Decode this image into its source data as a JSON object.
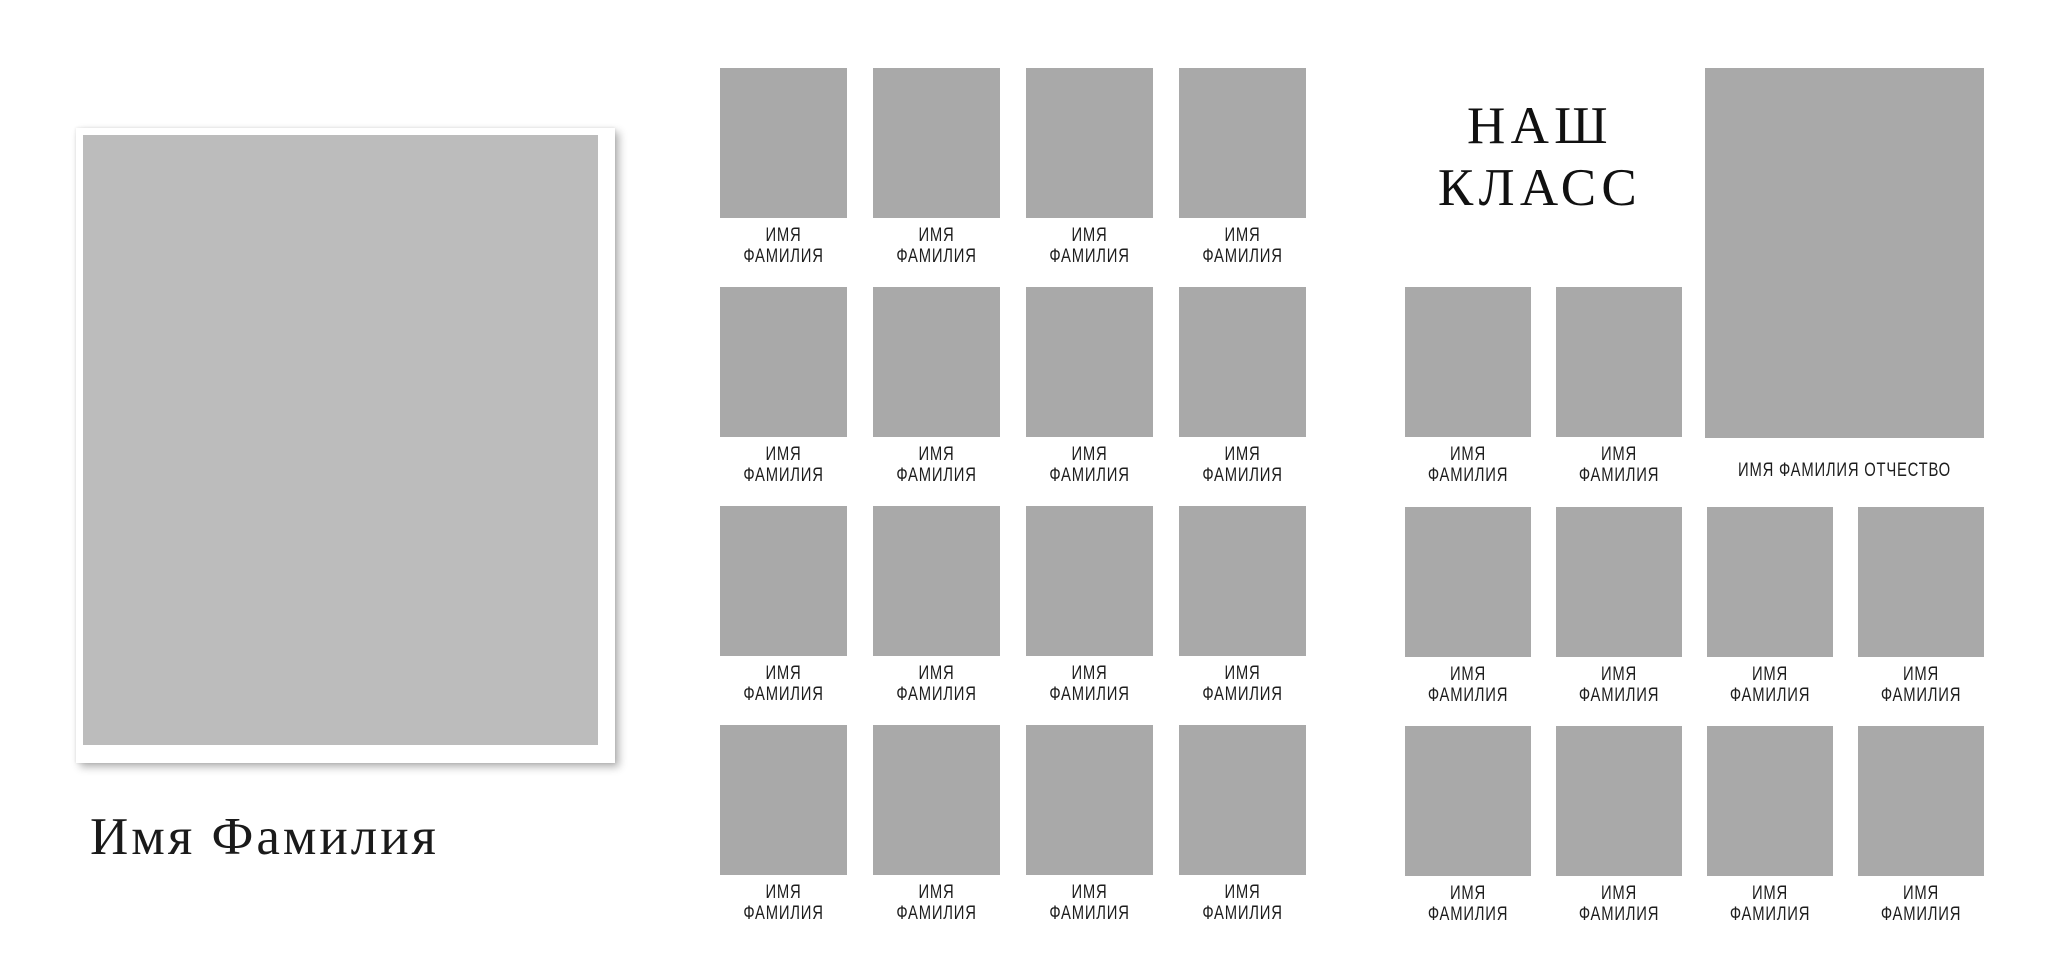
{
  "page": {
    "type": "class-photo-album-template",
    "background": "#ffffff"
  },
  "colors": {
    "cover_placeholder_gray": "#bcbcbc",
    "slot_placeholder_gray": "#a9a9a9",
    "text_dark": "#1d1d1d",
    "title_black": "#111111",
    "card_white": "#ffffff"
  },
  "left_page": {
    "caption": "Имя Фамилия"
  },
  "title": {
    "line1": "НАШ",
    "line2": "КЛАСС"
  },
  "labels": {
    "student_line1": "ИМЯ",
    "student_line2": "ФАМИЛИЯ",
    "teacher": "ИМЯ ФАМИЛИЯ ОТЧЕСТВО"
  },
  "middle_grid": {
    "rows": 4,
    "cols": 4,
    "slot_count": 16
  },
  "right_page": {
    "small_slot_count": 2,
    "teacher_slot_count": 1,
    "bottom_grid_rows": 2,
    "bottom_grid_cols": 4,
    "bottom_slot_count": 8
  }
}
